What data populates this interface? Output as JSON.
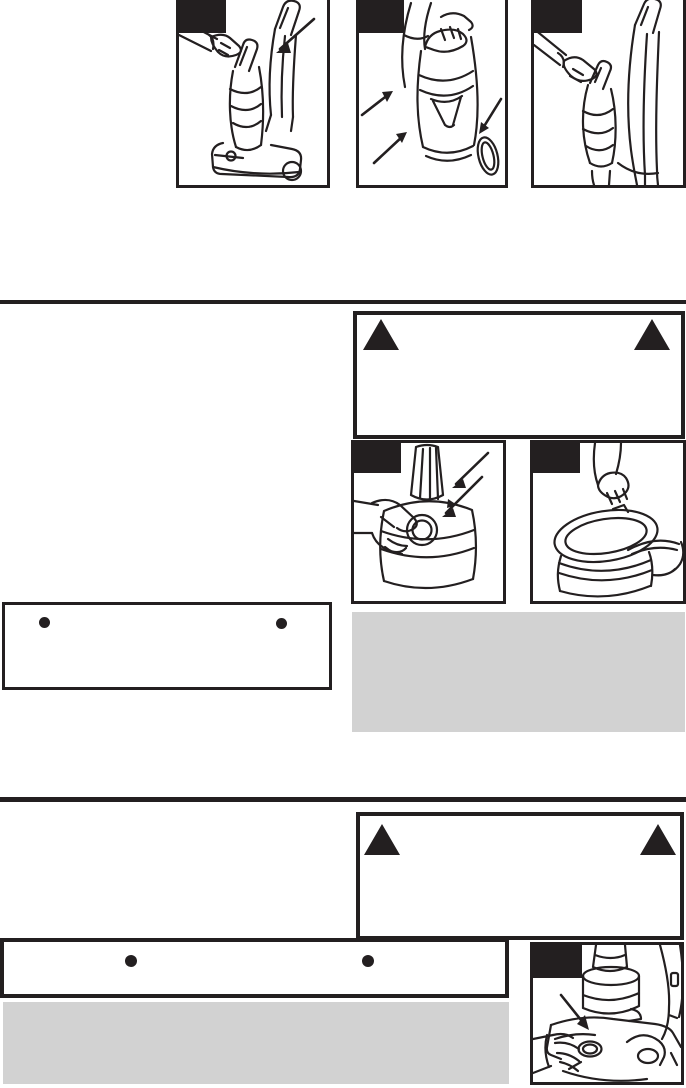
{
  "colors": {
    "ink": "#231f20",
    "paper": "#ffffff",
    "panel_gray": "#d2d2d2"
  },
  "top_row": {
    "figures": [
      {
        "name": "detach-dirt-cup",
        "badge_label": ""
      },
      {
        "name": "hold-dirt-cup-arrows",
        "badge_label": ""
      },
      {
        "name": "reattach-dirt-cup",
        "badge_label": ""
      }
    ]
  },
  "middle_section": {
    "warning_box": {
      "icons": [
        "warning-triangle",
        "warning-triangle"
      ],
      "body_text": ""
    },
    "figures": [
      {
        "name": "remove-filter-from-cup",
        "badge_label": ""
      },
      {
        "name": "lift-lid-off-tank",
        "badge_label": ""
      }
    ],
    "bullet_box": {
      "items": [
        "",
        ""
      ]
    },
    "note_panel_text": ""
  },
  "bottom_section": {
    "warning_box": {
      "icons": [
        "warning-triangle",
        "warning-triangle"
      ],
      "body_text": ""
    },
    "bullet_box": {
      "items": [
        "",
        ""
      ]
    },
    "note_panel_text": "",
    "figure": {
      "name": "base-latch-closeup",
      "badge_label": ""
    }
  }
}
